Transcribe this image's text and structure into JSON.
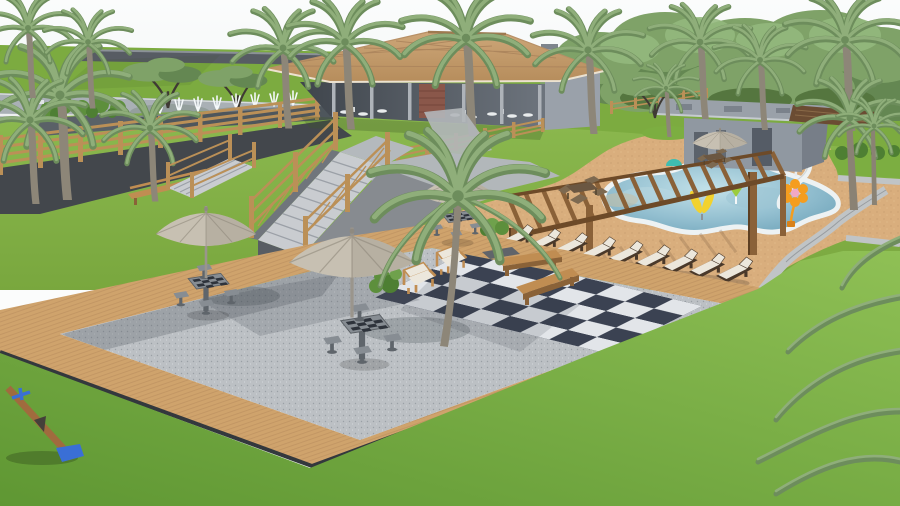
{
  "scene": {
    "description": "Daylight 3D architectural rendering of a condominium leisure area: free-form swimming pool with kids' splash toys and a white water slide, timber pergola with a row of sun loungers, sandy pool deck, clubhouse pavilion with tiled hip roof, flat-roofed pool house, gravel picnic patio with chess tables under beige umbrellas, a giant outdoor chessboard, wooden benches and armchairs, timber deck walkways, rail fences, a staircase, fountain jets by the street, palm trees and wide lawns with a seesaw."
  },
  "inventory": {
    "pools": 1,
    "sun_loungers": 9,
    "patio_umbrellas": 4,
    "chess_tables": 3,
    "garden_benches": 3,
    "armchairs": 2,
    "dining_sets": 2,
    "pergolas": 1,
    "staircases": 2,
    "seesaws": 1,
    "palm_trees": 15
  },
  "colors": {
    "sky1": "#eef2f4",
    "sky2": "#fbfcfc",
    "field": "#7cab40",
    "wall": "#575c63",
    "wallTop": "#8b9197",
    "road": "#a9b0b5",
    "roadLine": "#eef0f0",
    "grassMid1": "#8cb94f",
    "grassMid2": "#79a73e",
    "grassFore1": "#8fc055",
    "grassFore2": "#5f9733",
    "grassWedge": "#7cae41",
    "mulch": "#43474c",
    "roof1": "#cda678",
    "roof2": "#b68d5c",
    "roofLine": "#a8815a",
    "eave": "#ece2d0",
    "bldg": "#9aa1aa",
    "bldgDark": "#777e88",
    "bldgLight": "#b7bcc2",
    "brick": "#8a574a",
    "sand": "#d9ae7d",
    "sandDot1": "#c49a6b",
    "sandDot2": "#eac89a",
    "woodDeck": "#cfa36c",
    "woodLine": "#b5885a",
    "deckEdge": "#33383d",
    "gravel": "#bcc0c4",
    "gravelDot": "#9aa0a6",
    "tileL": "#e2e5e9",
    "tileD": "#3b4252",
    "poolRim": "#edf2f3",
    "curb": "#c0c4c6",
    "pergola": "#8a6138",
    "pergolaDark": "#6d4a28",
    "fenceWood": "#bb9057",
    "benchWood": "#c08d52",
    "benchSide": "#8a6238",
    "loungerWood": "#4a392a",
    "cushion": "#ece7dc",
    "metal": "#878d93",
    "metalDark": "#5f656b",
    "umbrella": "#c7c0b2",
    "umbShade": "#a59d8f",
    "umbRib": "#8f887b",
    "stair": "#c9ccd0",
    "stairSide": "#70757c",
    "stairDark": "#585d63",
    "concrete": "#878b90",
    "trunk": "#8d8678",
    "palm1": "#8fae7a",
    "palm2": "#6d8d5c",
    "tree1": "#7fa268",
    "tree2": "#648752",
    "tree3": "#93b87d",
    "treeShade": "#55763f",
    "shrub": "#5d8f3c",
    "shrubD": "#4e7f33",
    "toyY": "#f2d22e",
    "toyO": "#f59d1e",
    "toyM": "#d62e8c",
    "toyT": "#3fbdb0",
    "toyL": "#9ccc3c",
    "toyP": "#f2a8c4",
    "seesaw": "#3a6fd6",
    "seesawWood": "#a06b3e",
    "white": "#f4f7f8"
  }
}
